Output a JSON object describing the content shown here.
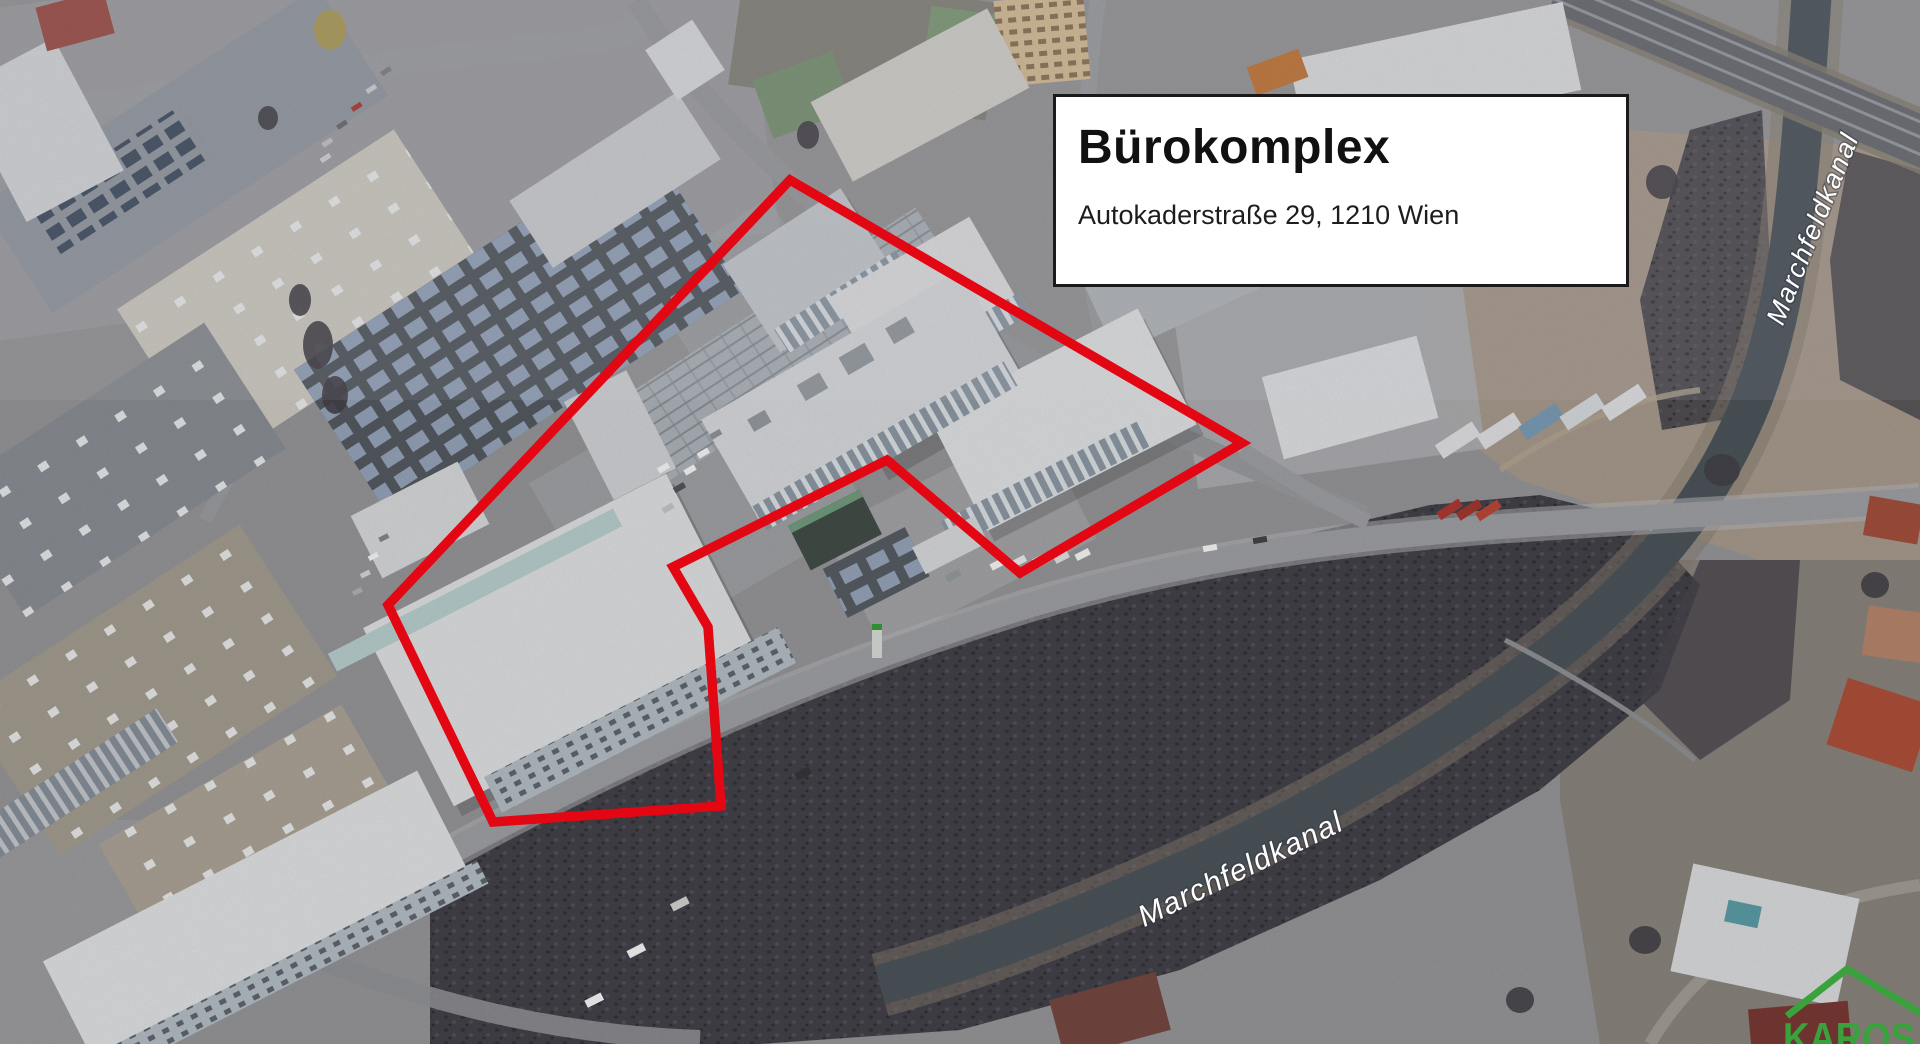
{
  "colors": {
    "boundary-red": "#e30613",
    "brand-green": "#3aa23c",
    "info-border": "#1a1a1a",
    "info-bg": "#ffffff",
    "info-text": "#111111",
    "label-white": "#ffffff"
  },
  "info_box": {
    "title": "Bürokomplex",
    "address": "Autokaderstraße 29, 1210 Wien"
  },
  "map_labels": {
    "canal_upper": {
      "text": "Marchfeldkanal"
    },
    "canal_lower": {
      "text": "Marchfeldkanal"
    }
  },
  "watermark": {
    "text": "KAROS"
  },
  "overlay": {
    "polygon_points": "790,180 1242,443 1020,573 887,460 673,567 708,627 721,806 493,822 388,605"
  }
}
